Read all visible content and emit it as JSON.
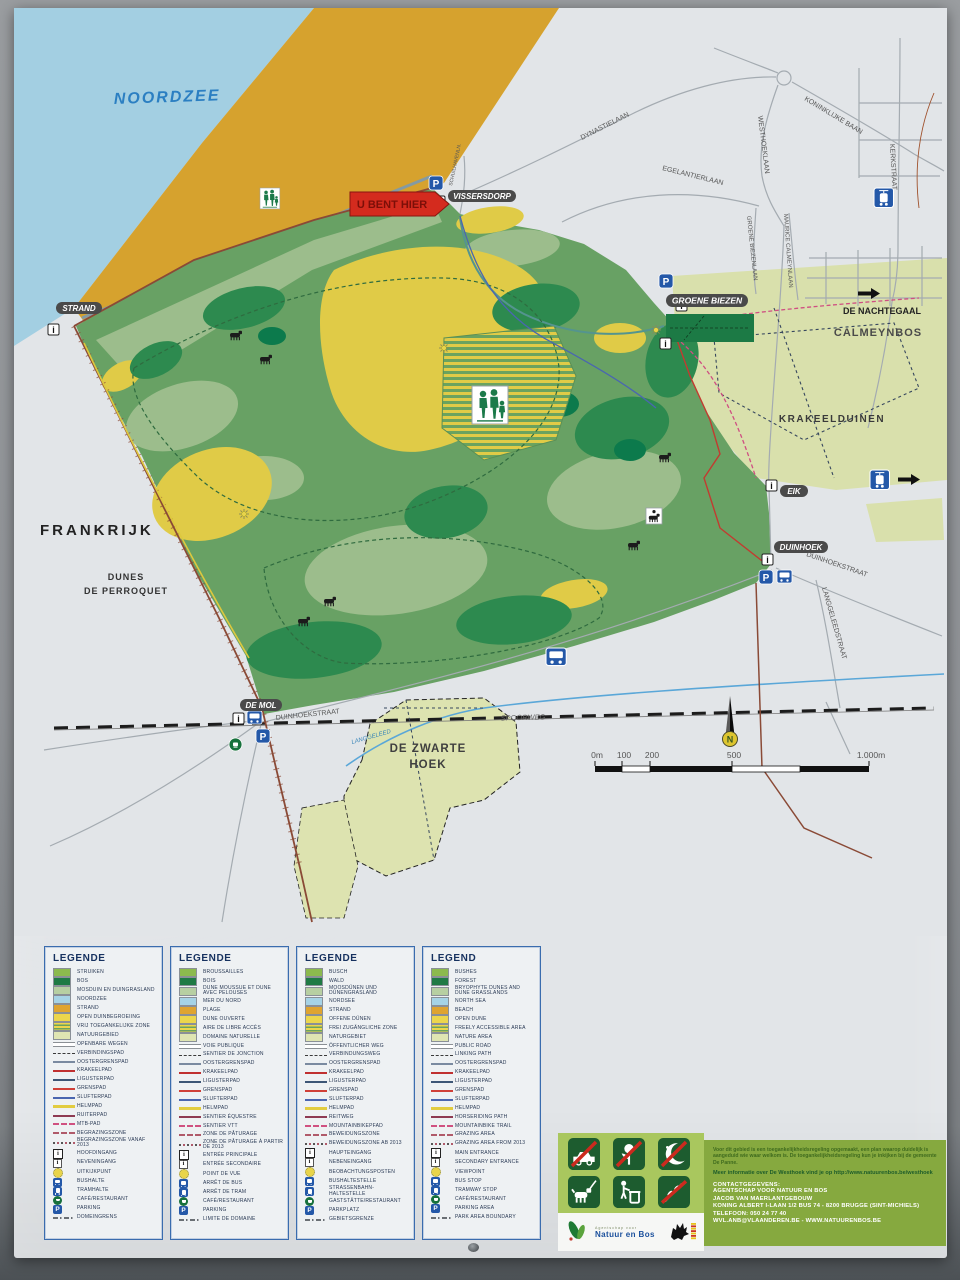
{
  "map": {
    "labels": {
      "sea": "NOORDZEE",
      "you_are_here": "U BENT HIER",
      "vissersdorp": "VISSERSDORP",
      "strand": "STRAND",
      "frankrijk": "FRANKRIJK",
      "dunes_line1": "DUNES",
      "dunes_line2": "DE PERROQUET",
      "groene_biezen": "GROENE BIEZEN",
      "de_nachtegaal": "DE NACHTEGAAL",
      "calmeynbos": "CALMEYNBOS",
      "krakeelduinen": "KRAKEELDUINEN",
      "eik": "EIK",
      "duinhoek": "DUINHOEK",
      "de_mol": "DE MOL",
      "zwarte_line1": "DE ZWARTE",
      "zwarte_line2": "HOEK",
      "spoorweg": "SPOORWEG",
      "langgeleed": "LANGGELEED"
    },
    "streets": {
      "dynastielaan": "DYNASTIELAAN",
      "koninklijke_baan": "KONINKLIJKE BAAN",
      "westhoeklaan": "WESTHOEKLAAN",
      "kerkstraat": "KERKSTRAAT",
      "egelantierlaan": "EGELANTIERLAAN",
      "groene_biezenlaan": "GROENE BIEZENLAAN",
      "maurice_calmeynlaan": "MAURICE CALMEYNLAAN",
      "schuilhavenln": "SCHUILHAVENLN.",
      "duinhoekstraat_west": "DUINHOEKSTRAAT",
      "duinhoekstraat_east": "DUINHOEKSTRAAT",
      "langgeleedstraat": "LANGGELEEDSTRAAT"
    },
    "icons": {
      "parking_letter": "P",
      "info_letter": "i",
      "compass_letter": "N"
    },
    "scale": {
      "ticks": [
        "0m",
        "100",
        "200",
        "500",
        "1.000m"
      ]
    }
  },
  "legend": {
    "panels": [
      {
        "title": "LEGENDE",
        "rows": [
          {
            "sym": "area-bushes",
            "label": "STRUIKEN"
          },
          {
            "sym": "area-forest",
            "label": "BOS"
          },
          {
            "sym": "area-mossdune",
            "label": "MOSDUIN EN DUINGRASLAND"
          },
          {
            "sym": "area-sea",
            "label": "NOORDZEE"
          },
          {
            "sym": "area-beach",
            "label": "STRAND"
          },
          {
            "sym": "area-opendune",
            "label": "OPEN DUINBEGROEIING"
          },
          {
            "sym": "area-freezone",
            "label": "VRIJ TOEGANKELIJKE ZONE"
          },
          {
            "sym": "area-nature",
            "label": "NATUURGEBIED"
          },
          {
            "sym": "line-road",
            "label": "OPENBARE WEGEN"
          },
          {
            "sym": "line-linking",
            "label": "VERBINDINGSPAD"
          },
          {
            "sym": "line-ooster",
            "label": "OOSTERGRENSPAD"
          },
          {
            "sym": "line-krakeel",
            "label": "KRAKEELPAD"
          },
          {
            "sym": "line-liguster",
            "label": "LIGUSTERPAD"
          },
          {
            "sym": "line-grens",
            "label": "GRENSPAD"
          },
          {
            "sym": "line-slufter",
            "label": "SLUFTERPAD"
          },
          {
            "sym": "line-helm",
            "label": "HELMPAD"
          },
          {
            "sym": "line-ruiter",
            "label": "RUITERPAD"
          },
          {
            "sym": "line-mtb",
            "label": "MTB-PAD"
          },
          {
            "sym": "line-grazing",
            "label": "BEGRAZINGSZONE"
          },
          {
            "sym": "line-grazing2",
            "label": "BEGRAZINGSZONE VANAF 2013"
          },
          {
            "sym": "icon-main-entrance",
            "label": "HOOFDINGANG"
          },
          {
            "sym": "icon-secondary-entrance",
            "label": "NEVENINGANG"
          },
          {
            "sym": "icon-viewpoint",
            "label": "UITKIJKPUNT"
          },
          {
            "sym": "icon-bus",
            "label": "BUSHALTE"
          },
          {
            "sym": "icon-tram",
            "label": "TRAMHALTE"
          },
          {
            "sym": "icon-cafe",
            "label": "CAFÉ/RESTAURANT"
          },
          {
            "sym": "icon-parking",
            "label": "PARKING"
          },
          {
            "sym": "line-boundary",
            "label": "DOMEINGRENS"
          }
        ]
      },
      {
        "title": "LEGENDE",
        "rows": [
          {
            "sym": "area-bushes",
            "label": "BROUSSAILLES"
          },
          {
            "sym": "area-forest",
            "label": "BOIS"
          },
          {
            "sym": "area-mossdune",
            "label": "DUNE MOUSSUE ET DUNE AVEC PELOUSES"
          },
          {
            "sym": "area-sea",
            "label": "MER DU NORD"
          },
          {
            "sym": "area-beach",
            "label": "PLAGE"
          },
          {
            "sym": "area-opendune",
            "label": "DUNE OUVERTE"
          },
          {
            "sym": "area-freezone",
            "label": "AIRE DE LIBRE ACCÈS"
          },
          {
            "sym": "area-nature",
            "label": "DOMAINE NATURELLE"
          },
          {
            "sym": "line-road",
            "label": "VOIE PUBLIQUE"
          },
          {
            "sym": "line-linking",
            "label": "SENTIER DE JONCTION"
          },
          {
            "sym": "line-ooster",
            "label": "OOSTERGRENSPAD"
          },
          {
            "sym": "line-krakeel",
            "label": "KRAKEELPAD"
          },
          {
            "sym": "line-liguster",
            "label": "LIGUSTERPAD"
          },
          {
            "sym": "line-grens",
            "label": "GRENSPAD"
          },
          {
            "sym": "line-slufter",
            "label": "SLUFTERPAD"
          },
          {
            "sym": "line-helm",
            "label": "HELMPAD"
          },
          {
            "sym": "line-ruiter",
            "label": "SENTIER ÉQUESTRE"
          },
          {
            "sym": "line-mtb",
            "label": "SENTIER VTT"
          },
          {
            "sym": "line-grazing",
            "label": "ZONE DE PÂTURAGE"
          },
          {
            "sym": "line-grazing2",
            "label": "ZONE DE PÂTURAGE À PARTIR DE 2013"
          },
          {
            "sym": "icon-main-entrance",
            "label": "ENTRÉE PRINCIPALE"
          },
          {
            "sym": "icon-secondary-entrance",
            "label": "ENTRÉE SECONDAIRE"
          },
          {
            "sym": "icon-viewpoint",
            "label": "POINT DE VUE"
          },
          {
            "sym": "icon-bus",
            "label": "ARRÊT DE BUS"
          },
          {
            "sym": "icon-tram",
            "label": "ARRÊT DE TRAM"
          },
          {
            "sym": "icon-cafe",
            "label": "CAFÉ/RESTAURANT"
          },
          {
            "sym": "icon-parking",
            "label": "PARKING"
          },
          {
            "sym": "line-boundary",
            "label": "LIMITE DE DOMAINE"
          }
        ]
      },
      {
        "title": "LEGENDE",
        "rows": [
          {
            "sym": "area-bushes",
            "label": "BUSCH"
          },
          {
            "sym": "area-forest",
            "label": "WALD"
          },
          {
            "sym": "area-mossdune",
            "label": "MOOSDÜNEN UND DÜNENGRASLAND"
          },
          {
            "sym": "area-sea",
            "label": "NORDSEE"
          },
          {
            "sym": "area-beach",
            "label": "STRAND"
          },
          {
            "sym": "area-opendune",
            "label": "OFFENE DÜNEN"
          },
          {
            "sym": "area-freezone",
            "label": "FREI ZUGÄNGLICHE ZONE"
          },
          {
            "sym": "area-nature",
            "label": "NATURGEBIET"
          },
          {
            "sym": "line-road",
            "label": "ÖFFENTLICHER WEG"
          },
          {
            "sym": "line-linking",
            "label": "VERBINDUNGSWEG"
          },
          {
            "sym": "line-ooster",
            "label": "OOSTERGRENSPAD"
          },
          {
            "sym": "line-krakeel",
            "label": "KRAKEELPAD"
          },
          {
            "sym": "line-liguster",
            "label": "LIGUSTERPAD"
          },
          {
            "sym": "line-grens",
            "label": "GRENSPAD"
          },
          {
            "sym": "line-slufter",
            "label": "SLUFTERPAD"
          },
          {
            "sym": "line-helm",
            "label": "HELMPAD"
          },
          {
            "sym": "line-ruiter",
            "label": "REITWEG"
          },
          {
            "sym": "line-mtb",
            "label": "MOUNTAINBIKEPFAD"
          },
          {
            "sym": "line-grazing",
            "label": "BEWEIDUNGSZONE"
          },
          {
            "sym": "line-grazing2",
            "label": "BEWEIDUNGSZONE AB 2013"
          },
          {
            "sym": "icon-main-entrance",
            "label": "HAUPTEINGANG"
          },
          {
            "sym": "icon-secondary-entrance",
            "label": "NEBENEINGANG"
          },
          {
            "sym": "icon-viewpoint",
            "label": "BEOBACHTUNGSPOSTEN"
          },
          {
            "sym": "icon-bus",
            "label": "BUSHALTESTELLE"
          },
          {
            "sym": "icon-tram",
            "label": "STRASSENBAHN-HALTESTELLE"
          },
          {
            "sym": "icon-cafe",
            "label": "GASTSTÄTTE/RESTAURANT"
          },
          {
            "sym": "icon-parking",
            "label": "PARKPLATZ"
          },
          {
            "sym": "line-boundary",
            "label": "GEBIETSGRENZE"
          }
        ]
      },
      {
        "title": "LEGEND",
        "rows": [
          {
            "sym": "area-bushes",
            "label": "BUSHES"
          },
          {
            "sym": "area-forest",
            "label": "FOREST"
          },
          {
            "sym": "area-mossdune",
            "label": "BRYOPHYTE DUNES AND DUNE GRASSLANDS"
          },
          {
            "sym": "area-sea",
            "label": "NORTH SEA"
          },
          {
            "sym": "area-beach",
            "label": "BEACH"
          },
          {
            "sym": "area-opendune",
            "label": "OPEN DUNE"
          },
          {
            "sym": "area-freezone",
            "label": "FREELY ACCESSIBLE AREA"
          },
          {
            "sym": "area-nature",
            "label": "NATURE AREA"
          },
          {
            "sym": "line-road",
            "label": "PUBLIC ROAD"
          },
          {
            "sym": "line-linking",
            "label": "LINKING PATH"
          },
          {
            "sym": "line-ooster",
            "label": "OOSTERGRENSPAD"
          },
          {
            "sym": "line-krakeel",
            "label": "KRAKEELPAD"
          },
          {
            "sym": "line-liguster",
            "label": "LIGUSTERPAD"
          },
          {
            "sym": "line-grens",
            "label": "GRENSPAD"
          },
          {
            "sym": "line-slufter",
            "label": "SLUFTERPAD"
          },
          {
            "sym": "line-helm",
            "label": "HELMPAD"
          },
          {
            "sym": "line-ruiter",
            "label": "HORSERIDING PATH"
          },
          {
            "sym": "line-mtb",
            "label": "MOUNTAINBIKE TRAIL"
          },
          {
            "sym": "line-grazing",
            "label": "GRAZING AREA"
          },
          {
            "sym": "line-grazing2",
            "label": "GRAZING AREA FROM 2013"
          },
          {
            "sym": "icon-main-entrance",
            "label": "MAIN ENTRANCE"
          },
          {
            "sym": "icon-secondary-entrance",
            "label": "SECONDARY ENTRANCE"
          },
          {
            "sym": "icon-viewpoint",
            "label": "VIEWPOINT"
          },
          {
            "sym": "icon-bus",
            "label": "BUS STOP"
          },
          {
            "sym": "icon-tram",
            "label": "TRAMWAY STOP"
          },
          {
            "sym": "icon-cafe",
            "label": "CAFÉ/RESTAURANT"
          },
          {
            "sym": "icon-parking",
            "label": "PARKING AREA"
          },
          {
            "sym": "line-boundary",
            "label": "PARK AREA BOUNDARY"
          }
        ]
      }
    ]
  },
  "info": {
    "pictograms": [
      "no-motor-vehicles",
      "no-flower-picking",
      "no-night-access",
      "dog-on-leash",
      "use-litter-bin",
      "no-branch-cutting"
    ],
    "access_text": "Voor dit gebied is een toegankelijkheidsregeling opgemaakt, een plan waarop duidelijk is aangeduid wie waar welkom is. De toegankelijkheidsregeling kun je inkijken bij de gemeente De Panne.",
    "more_info": "Meer informatie over De Westhoek vind je op http://www.natuurenbos.be/westhoek",
    "contact_header": "CONTACTGEGEVENS:",
    "contact_lines": [
      "AGENTSCHAP VOOR NATUUR EN BOS",
      "JACOB VAN MAERLANTGEBOUW",
      "KONING ALBERT I-LAAN 1/2 BUS 74 - 8200 BRUGGE (SINT-MICHIELS)",
      "TELEFOON: 050 24 77 40",
      "WVL.ANB@VLAANDEREN.BE - WWW.NATUURENBOS.BE"
    ],
    "logo_small": "Agentschap voor",
    "logo_main": "Natuur en Bos"
  },
  "colors": {
    "sea": "#a3cfe2",
    "beach": "#d6a22e",
    "reserve": "#68a164",
    "forest": "#2d8a4f",
    "open_dune": "#e0cb47",
    "nature_area": "#d9e0ac",
    "badge": "#4a4a4a",
    "you_are_here_red": "#d42b1e",
    "icon_blue": "#2458a8",
    "legend_border": "#3a6cae"
  }
}
